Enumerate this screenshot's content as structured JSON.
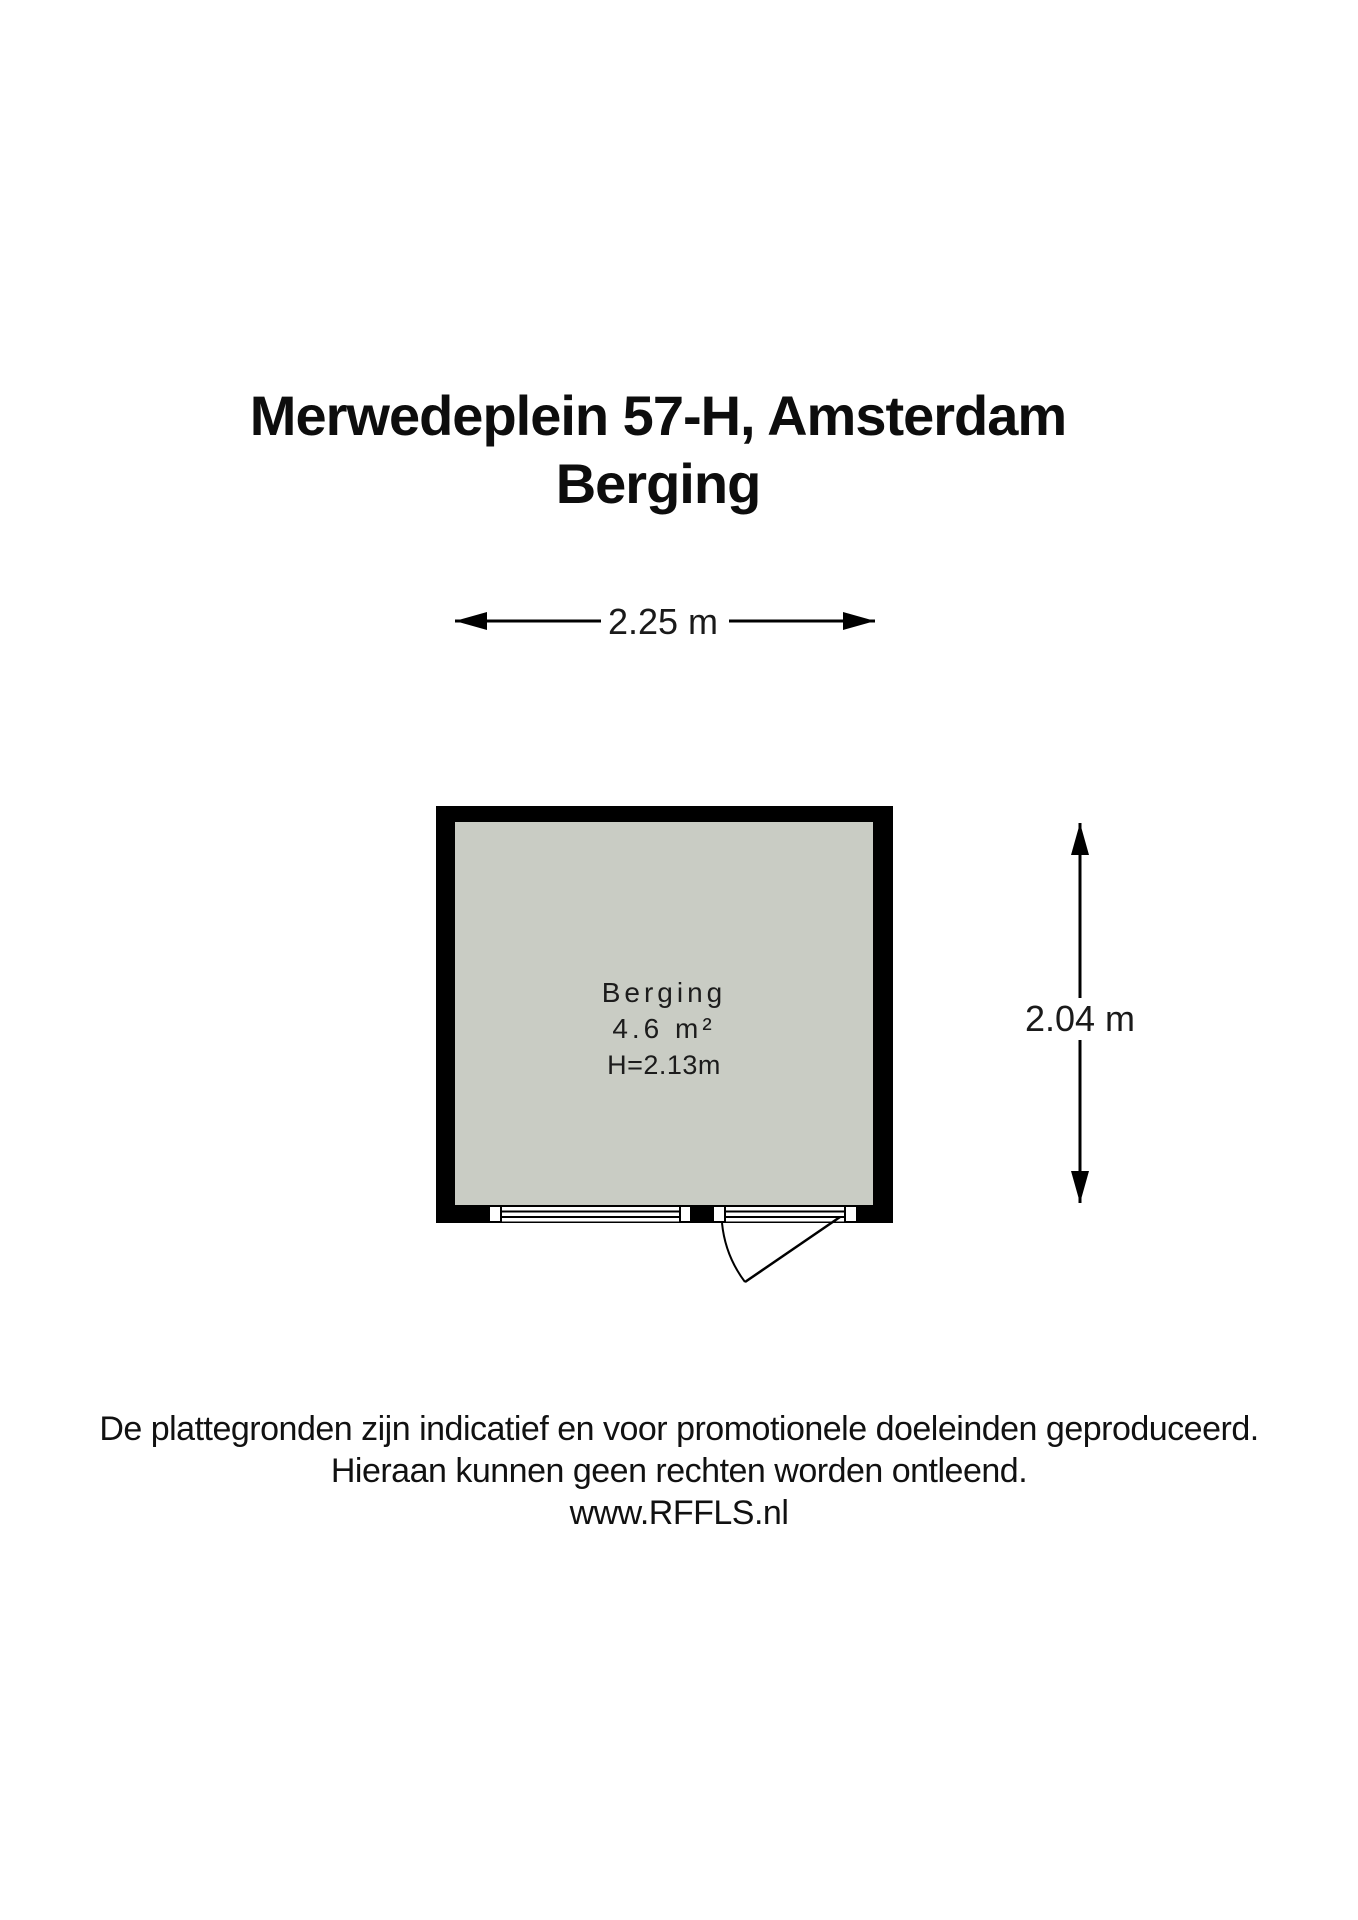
{
  "title": {
    "line1": "Merwedeplein 57-H, Amsterdam",
    "line2": "Berging"
  },
  "dimensions": {
    "width": "2.25 m",
    "height": "2.04 m"
  },
  "room": {
    "label": "Berging",
    "area": "4.6 m²",
    "ceiling_height": "H=2.13m"
  },
  "footer": {
    "line1": "De plattegronden zijn indicatief en voor promotionele doeleinden geproduceerd.",
    "line2": "Hieraan kunnen geen rechten worden ontleend.",
    "line3": "www.RFFLS.nl"
  },
  "colors": {
    "wall": "#000000",
    "floor": "#c9ccc4",
    "background": "#ffffff",
    "text": "#1a1a1a"
  }
}
